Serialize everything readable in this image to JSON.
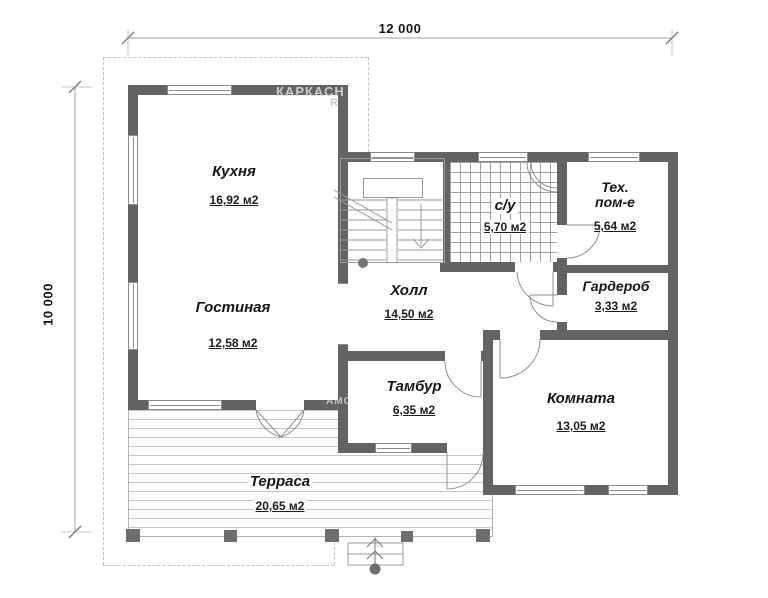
{
  "dimensions": {
    "width_label": "12 000",
    "height_label": "10 000"
  },
  "watermark": {
    "fragment_top": "КАРКАСН",
    "fragment_r": "R",
    "fragment_side": "АМС"
  },
  "rooms": {
    "kitchen": {
      "name": "Кухня",
      "area": "16,92 м2"
    },
    "living_room": {
      "name": "Гостиная",
      "area": "12,58 м2"
    },
    "hall": {
      "name": "Холл",
      "area": "14,50 м2"
    },
    "bathroom": {
      "name": "с/у",
      "area": "5,70 м2"
    },
    "tech_room": {
      "name_line1": "Тех.",
      "name_line2": "пом-е",
      "area": "5,64 м2"
    },
    "wardrobe": {
      "name": "Гардероб",
      "area": "3,33 м2"
    },
    "vestibule": {
      "name": "Тамбур",
      "area": "6,35 м2"
    },
    "room": {
      "name": "Комната",
      "area": "13,05 м2"
    },
    "terrace": {
      "name": "Терраса",
      "area": "20,65 м2"
    }
  }
}
